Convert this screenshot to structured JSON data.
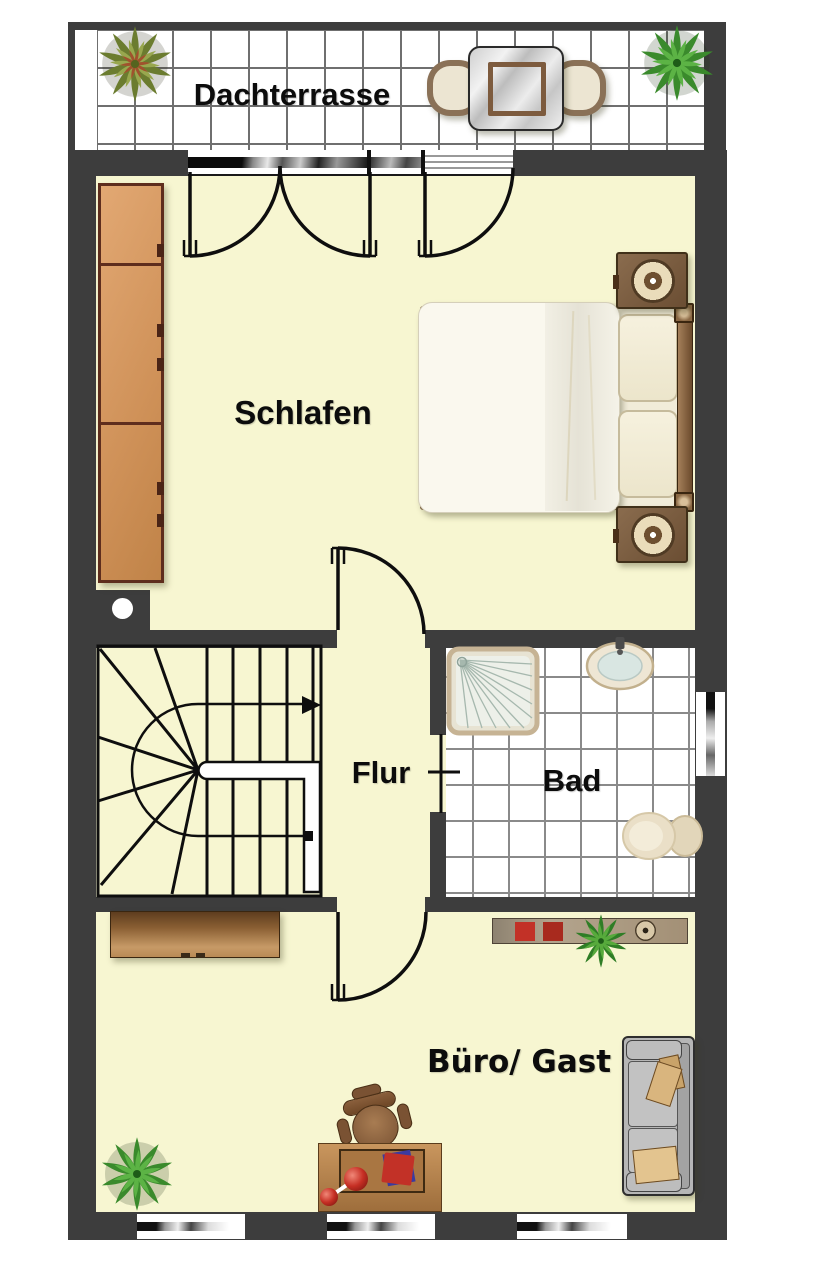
{
  "labels": {
    "terrace": "Dachterrasse",
    "bedroom": "Schlafen",
    "hallway": "Flur",
    "bathroom": "Bad",
    "office_guest": "Büro/ Gast"
  },
  "colors": {
    "wall": "#3d3d3d",
    "floor": "#f7f6d1",
    "line": "#0e0e0e",
    "tile_grid": "#6f6f6f",
    "wardrobe": "#d79a62",
    "wood": "#b5824f",
    "wood_dark": "#6b4726",
    "fixture": "#e8deca",
    "sofa": "#b6b6b6",
    "plant_green": "#3a8a2c",
    "plant_olive": "#6b7c2f",
    "accent_red": "#c23127",
    "linen": "#faf8ee"
  }
}
